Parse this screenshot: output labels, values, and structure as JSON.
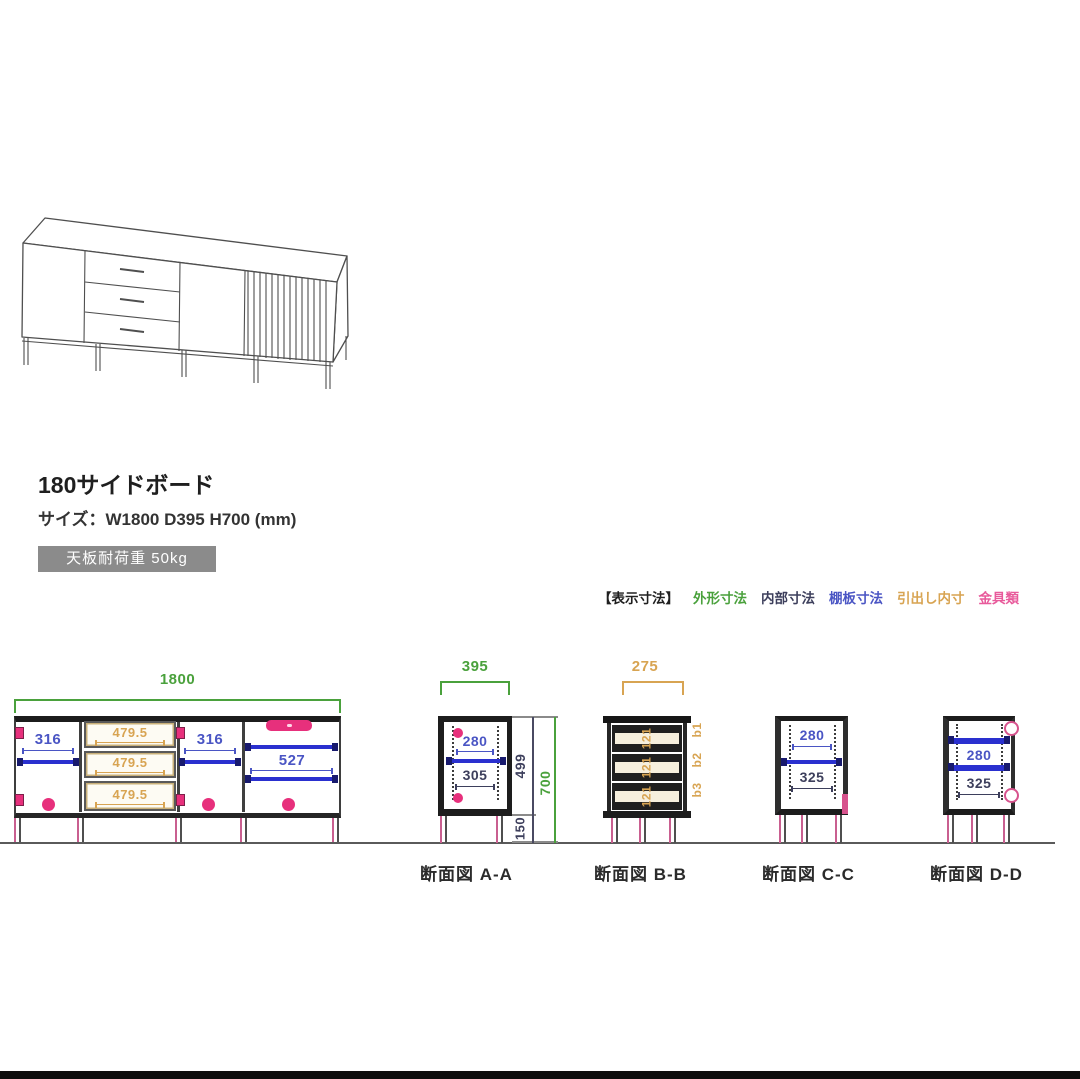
{
  "product": {
    "title": "180サイドボード",
    "size": "サイズ：W1800  D395 H700 (mm)",
    "badge": "天板耐荷重 50kg"
  },
  "legend": {
    "prefix": "【表示寸法】",
    "items": [
      {
        "label": "外形寸法",
        "color": "#4aa13c"
      },
      {
        "label": "内部寸法",
        "color": "#3d3f5c"
      },
      {
        "label": "棚板寸法",
        "color": "#4a55c4"
      },
      {
        "label": "引出し内寸",
        "color": "#d8a452"
      },
      {
        "label": "金具類",
        "color": "#e85a9b"
      }
    ]
  },
  "front": {
    "overall_width": "1800",
    "left_width": "316",
    "drawer_widths": [
      "479.5",
      "479.5",
      "479.5"
    ],
    "center_width": "316",
    "right_width": "527"
  },
  "sectionA": {
    "label": "断面図 A-A",
    "top_width": "395",
    "shelf": "280",
    "inner": "305",
    "inner_height": "499",
    "height": "700",
    "leg": "150"
  },
  "sectionB": {
    "label": "断面図 B-B",
    "top_width": "275",
    "drawer_texts": [
      "121",
      "121",
      "121"
    ],
    "side_labels": [
      "b1",
      "b2",
      "b3"
    ]
  },
  "sectionC": {
    "label": "断面図 C-C",
    "shelf": "280",
    "inner": "325"
  },
  "sectionD": {
    "label": "断面図 D-D",
    "shelf": "280",
    "inner": "325"
  }
}
